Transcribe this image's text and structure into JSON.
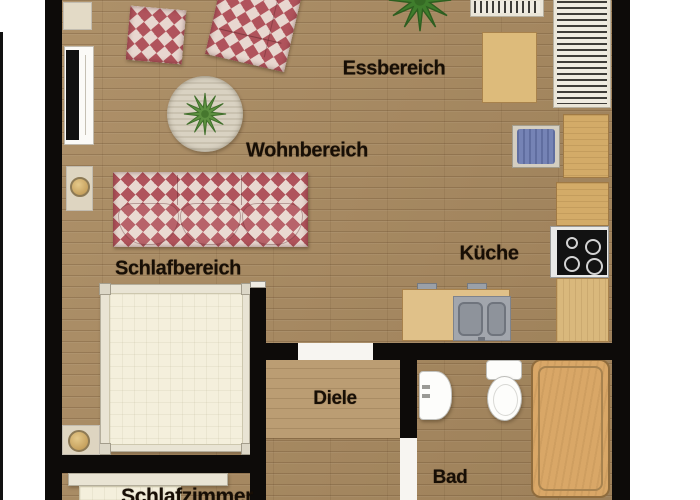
{
  "floorplan": {
    "room_labels": {
      "essbereich": "Essbereich",
      "wohnbereich": "Wohnbereich",
      "schlafbereich": "Schlafbereich",
      "kueche": "Küche",
      "diele": "Diele",
      "bad": "Bad",
      "schlafzimmer": "Schlafzimmer"
    },
    "colors": {
      "wall": "#0d0b09",
      "floor_wood": "#a98a60",
      "hall_panel_wood": "#bb9d73",
      "fabric_red": "#ae4d56",
      "fabric_cream": "#e9d8d0",
      "furniture_wood_light": "#d9b87c",
      "mattress_cream": "#f4efdc",
      "bathtub_tan": "#d9a767",
      "chair_blue": "#7583b5",
      "plant_green": "#4e8a33",
      "rug_beige": "#d9d2c2",
      "stove_black": "#121212",
      "sink_gray": "#a2a6ad"
    }
  }
}
